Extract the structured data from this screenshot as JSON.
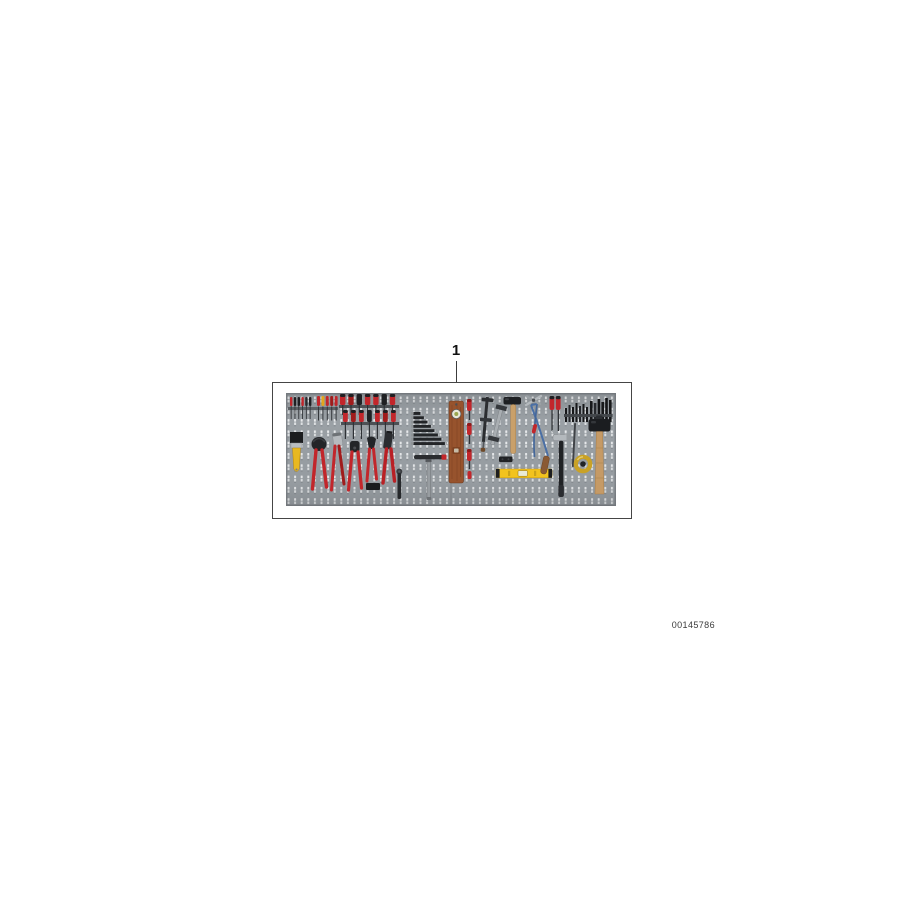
{
  "page": {
    "background_color": "#ffffff",
    "document_number": "00145786"
  },
  "callout": {
    "label": "1",
    "line_color": "#3c3c3c"
  },
  "frame": {
    "border_color": "#454545",
    "background_color": "#ffffff"
  },
  "board": {
    "surface_color": "#9aa0a5",
    "edge_color": "#81868b",
    "hole_color": "#e8eaec",
    "seam_color": "#888d92",
    "accent_red": "#c2262b",
    "accent_yellow": "#f2c31e",
    "accent_blue": "#4a6fa5",
    "wood_color": "#c59a66",
    "tools": [
      "small screwdriver rack",
      "screwdriver assortment",
      "paintbrush",
      "carpenter pincers",
      "water pump pliers",
      "combination pliers",
      "side cutters",
      "crimping tool",
      "storage block",
      "ratchet",
      "hex key set",
      "T-handle socket wrench",
      "wooden spirit level",
      "screw clamp set",
      "F-clamp",
      "C-clamp",
      "machinist hammer",
      "connector block",
      "spirit level",
      "hacksaw",
      "gripping pliers",
      "screwdriver pair",
      "punch and bit set",
      "claw hammer",
      "round file",
      "brass plumb bob",
      "sledge hammer"
    ]
  }
}
